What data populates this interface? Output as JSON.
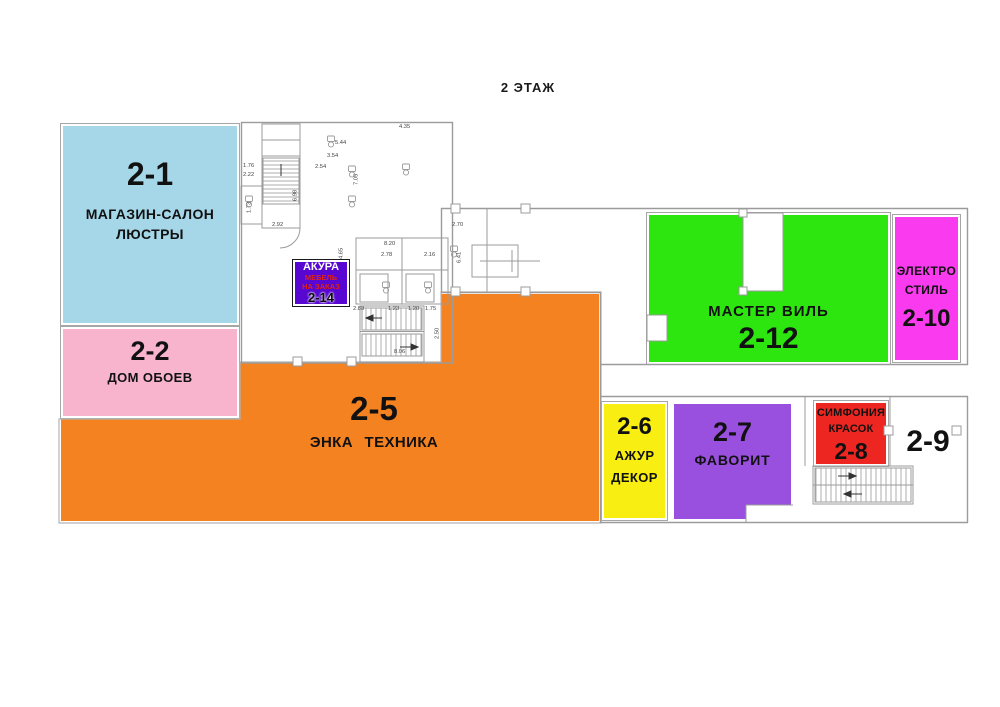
{
  "title": "2 ЭТАЖ",
  "colors": {
    "blue": "#a5d7e8",
    "pink": "#f8b4cd",
    "orange": "#f58220",
    "green": "#2ee60f",
    "magenta": "#f93aee",
    "yellow": "#f8ee12",
    "purple": "#9a50de",
    "red": "#ee2621",
    "badge": "#5707d1",
    "badgeRed": "#e02317",
    "wall": "#9b9b9b",
    "ink": "#111111"
  },
  "regions": {
    "r21": {
      "number": "2-1",
      "name1": "МАГАЗИН-САЛОН",
      "name2": "ЛЮСТРЫ"
    },
    "r22": {
      "number": "2-2",
      "name1": "ДОМ ОБОЕВ"
    },
    "r25": {
      "number": "2-5",
      "name1": "ЭНКА ТЕХНИКА"
    },
    "r26": {
      "number": "2-6",
      "name1": "АЖУР",
      "name2": "ДЕКОР"
    },
    "r27": {
      "number": "2-7",
      "name1": "ФАВОРИТ"
    },
    "r28": {
      "number": "2-8",
      "name1": "СИМФОНИЯ",
      "name2": "КРАСОК"
    },
    "r29": {
      "number": "2-9"
    },
    "r210": {
      "number": "2-10",
      "name1": "ЭЛЕКТРО",
      "name2": "СТИЛЬ"
    },
    "r212": {
      "number": "2-12",
      "name1": "МАСТЕР ВИЛЬ"
    },
    "r214": {
      "number": "2-14",
      "brand": "АКУРА",
      "line1": "МЕБЕЛЬ",
      "line2": "НА ЗАКАЗ"
    }
  },
  "plan": {
    "dimension_labels": [
      {
        "t": "4.35",
        "x": 399,
        "y": 124
      },
      {
        "t": "5.44",
        "x": 335,
        "y": 140
      },
      {
        "t": "3.54",
        "x": 327,
        "y": 153
      },
      {
        "t": "2.54",
        "x": 315,
        "y": 164
      },
      {
        "t": "7.05",
        "x": 359,
        "y": 178,
        "v": true
      },
      {
        "t": "6.98",
        "x": 298,
        "y": 194,
        "v": true
      },
      {
        "t": "1.76",
        "x": 243,
        "y": 163
      },
      {
        "t": "2.22",
        "x": 243,
        "y": 172
      },
      {
        "t": "1.73",
        "x": 252,
        "y": 206,
        "v": true
      },
      {
        "t": "2.92",
        "x": 272,
        "y": 222
      },
      {
        "t": "8.20",
        "x": 384,
        "y": 241
      },
      {
        "t": "2.78",
        "x": 381,
        "y": 252
      },
      {
        "t": "2.16",
        "x": 424,
        "y": 252
      },
      {
        "t": "2.70",
        "x": 452,
        "y": 222
      },
      {
        "t": "6.41",
        "x": 462,
        "y": 256,
        "v": true
      },
      {
        "t": "4.65",
        "x": 344,
        "y": 252,
        "v": true
      },
      {
        "t": "2.88",
        "x": 353,
        "y": 306
      },
      {
        "t": "1.23",
        "x": 388,
        "y": 306
      },
      {
        "t": "1.20",
        "x": 408,
        "y": 306
      },
      {
        "t": "1.75",
        "x": 425,
        "y": 306
      },
      {
        "t": "8.06",
        "x": 394,
        "y": 349
      },
      {
        "t": "2.50",
        "x": 440,
        "y": 332,
        "v": true
      }
    ]
  }
}
